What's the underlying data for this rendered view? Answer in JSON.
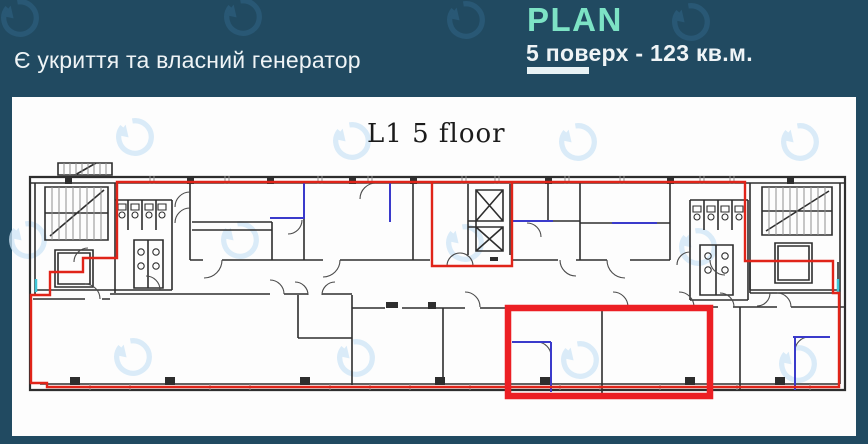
{
  "header": {
    "note": "Є укриття та власний генератор",
    "plan_label": "PLAN",
    "floor_info": "5 поверх  - 123 кв.м."
  },
  "plan": {
    "title": "L1  5 floor"
  },
  "icons": {
    "watermark": "circular-arrow-logo-watermark"
  },
  "colors": {
    "background": "#214A61",
    "panel": "#FDFDFD",
    "text_light": "#EFF4F6",
    "mint": "#7DE3C5",
    "underline": "#E8F2F5",
    "wall": "#2E2E2E",
    "tick_gray": "#8F8F8F",
    "red_outline": "#E02419",
    "red_unit": "#EC1F24",
    "blue_wall": "#3A3ACB",
    "cyan_window": "#3FC6D8",
    "wm_dark": "#2B5C7A",
    "wm_light": "#CFE6F7",
    "title_ink": "#1B1B1B"
  }
}
